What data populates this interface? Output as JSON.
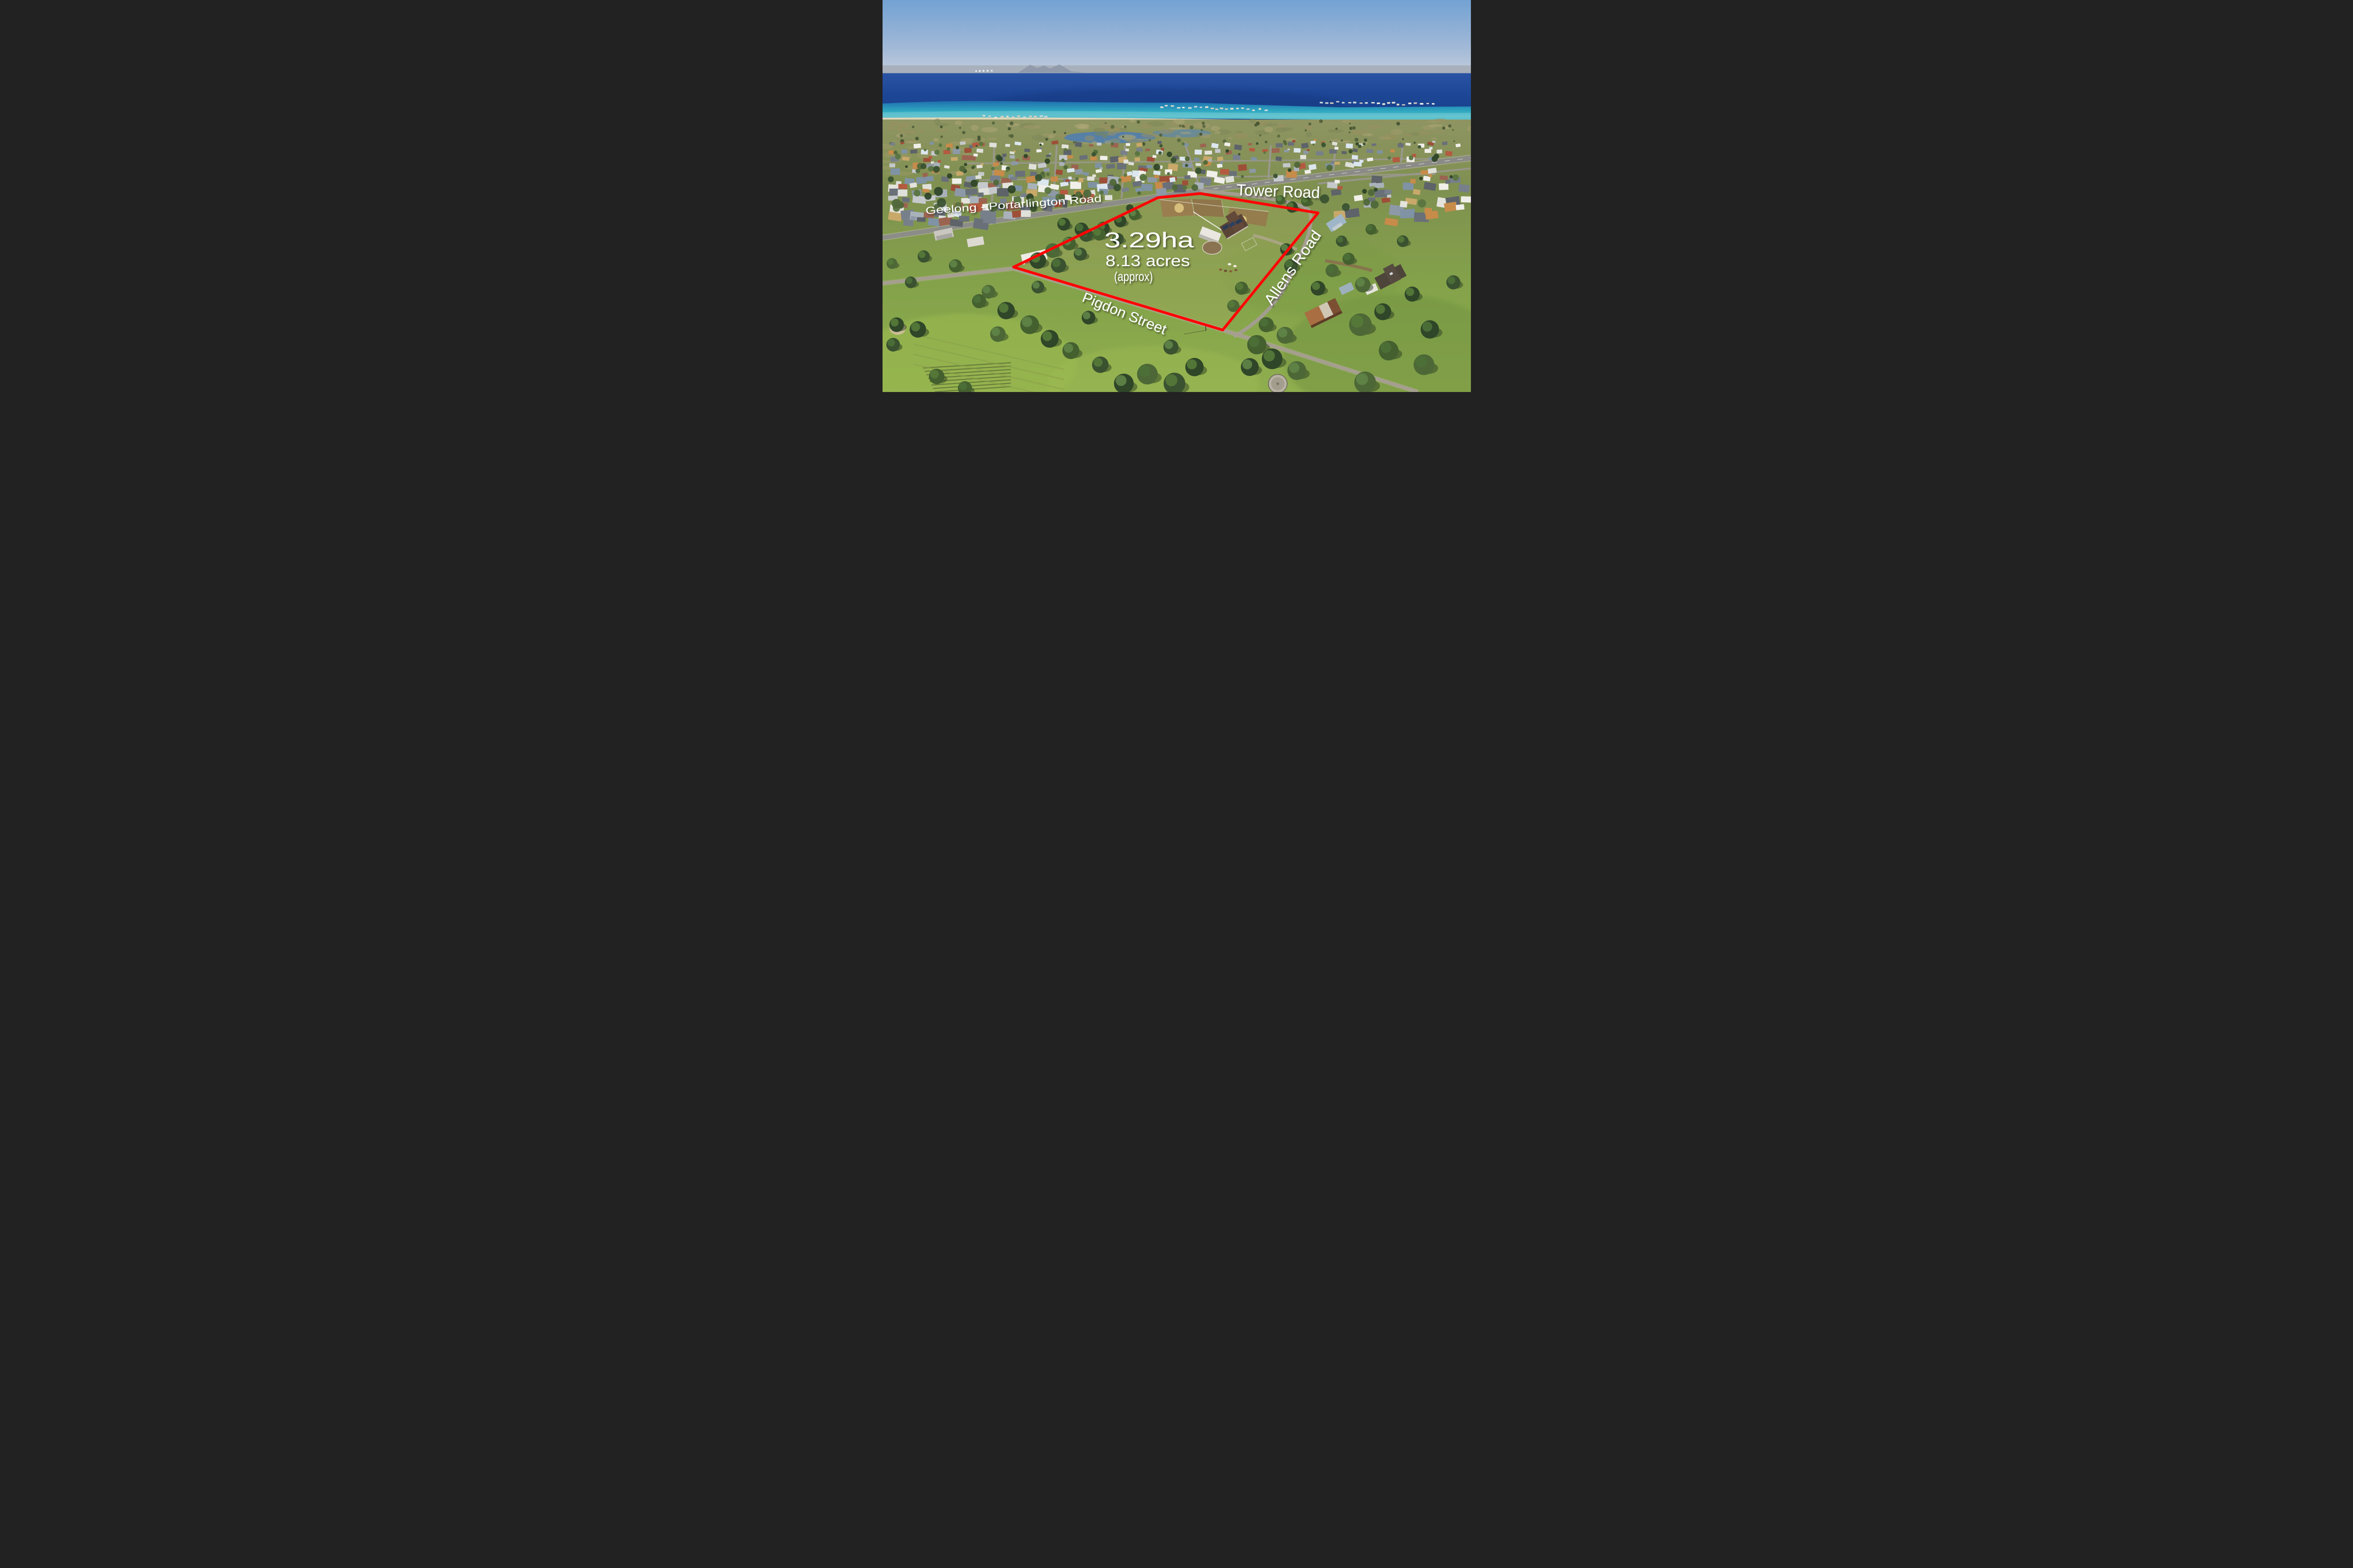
{
  "overlay": {
    "area_label": "3.29ha",
    "acres_label": "8.13 acres",
    "approx_label": "(approx)",
    "boundary_color": "#ff0505",
    "label_color": "#ffffff",
    "boundary_points": "1113,2270 2340,1680 2700,1645 3700,1810 2890,2805"
  },
  "road_labels": {
    "geelong_portarlington": "Geelong - Portarlington Road",
    "tower": "Tower Road",
    "allens": "Allens Road",
    "pigdon": "Pigdon Street"
  },
  "palette": {
    "sky": "#6d9ecf",
    "ocean_deep": "#1d4796",
    "shallows": "#2fa8c0",
    "fields_green": "#86a348",
    "scrub_olive": "#8f9464"
  }
}
